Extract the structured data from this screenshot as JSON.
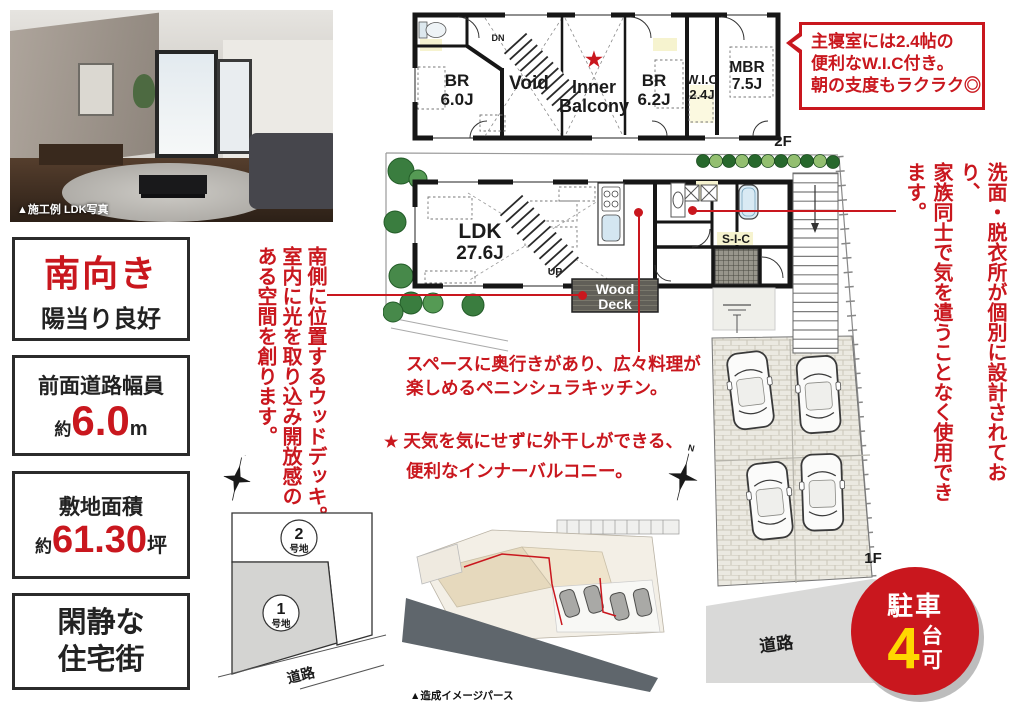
{
  "colors": {
    "accent_red": "#c9171e",
    "badge_yellow": "#ffd800",
    "wall_black": "#161616"
  },
  "photo": {
    "caption": "▲施工例 LDK写真"
  },
  "info_boxes": {
    "facing": {
      "title": "南向き",
      "subtitle": "陽当り良好"
    },
    "road_width": {
      "label": "前面道路幅員",
      "prefix": "約",
      "value": "6.0",
      "unit": "m"
    },
    "land_area": {
      "label": "敷地面積",
      "prefix": "約",
      "value": "61.30",
      "unit": "坪"
    },
    "quiet": {
      "line1": "閑静な",
      "line2": "住宅街"
    }
  },
  "floor2": {
    "floor_label": "2F",
    "dn": "DN",
    "star": "★",
    "rooms": {
      "br1": "BR",
      "br1_size": "6.0J",
      "void": "Void",
      "inner1": "Inner",
      "inner2": "Balcony",
      "br2": "BR",
      "br2_size": "6.2J",
      "wic": "W.I.C",
      "wic_size": "2.4J",
      "mbr": "MBR",
      "mbr_size": "7.5J"
    }
  },
  "floor1": {
    "floor_label": "1F",
    "up_stairs": "UP",
    "up_drive": "UP",
    "road": "道路",
    "rooms": {
      "ldk": "LDK",
      "ldk_size": "27.6J",
      "sic": "S-I-C",
      "wood1": "Wood",
      "wood2": "Deck"
    }
  },
  "compass_n": "N",
  "notes": {
    "wic_bubble": [
      "主寝室には2.4帖の",
      "便利なW.I.C付き。",
      "朝の支度もラクラク◎"
    ],
    "wood_deck": [
      "南側に位置するウッドデッキ。",
      "室内に光を取り込み開放感の",
      "ある空間を創ります。"
    ],
    "washroom": [
      "洗面・脱衣所が個別に設計されており、",
      "家族同士で気を遣うことなく使用できます。"
    ],
    "kitchen": [
      "スペースに奥行きがあり、広々料理が",
      "楽しめるペニンシュラキッチン。"
    ],
    "balcony": {
      "star": "★",
      "line1": "天気を気にせずに外干しができる、",
      "line2": "便利なインナーバルコニー。"
    }
  },
  "site_plan": {
    "lot2_num": "2",
    "lot2_suffix": "号地",
    "lot1_num": "1",
    "lot1_suffix": "号地",
    "road": "道路"
  },
  "perspective": {
    "caption": "▲造成イメージパース"
  },
  "parking_badge": {
    "top": "駐車",
    "number": "4",
    "unit_top": "台",
    "unit_bottom": "可"
  }
}
